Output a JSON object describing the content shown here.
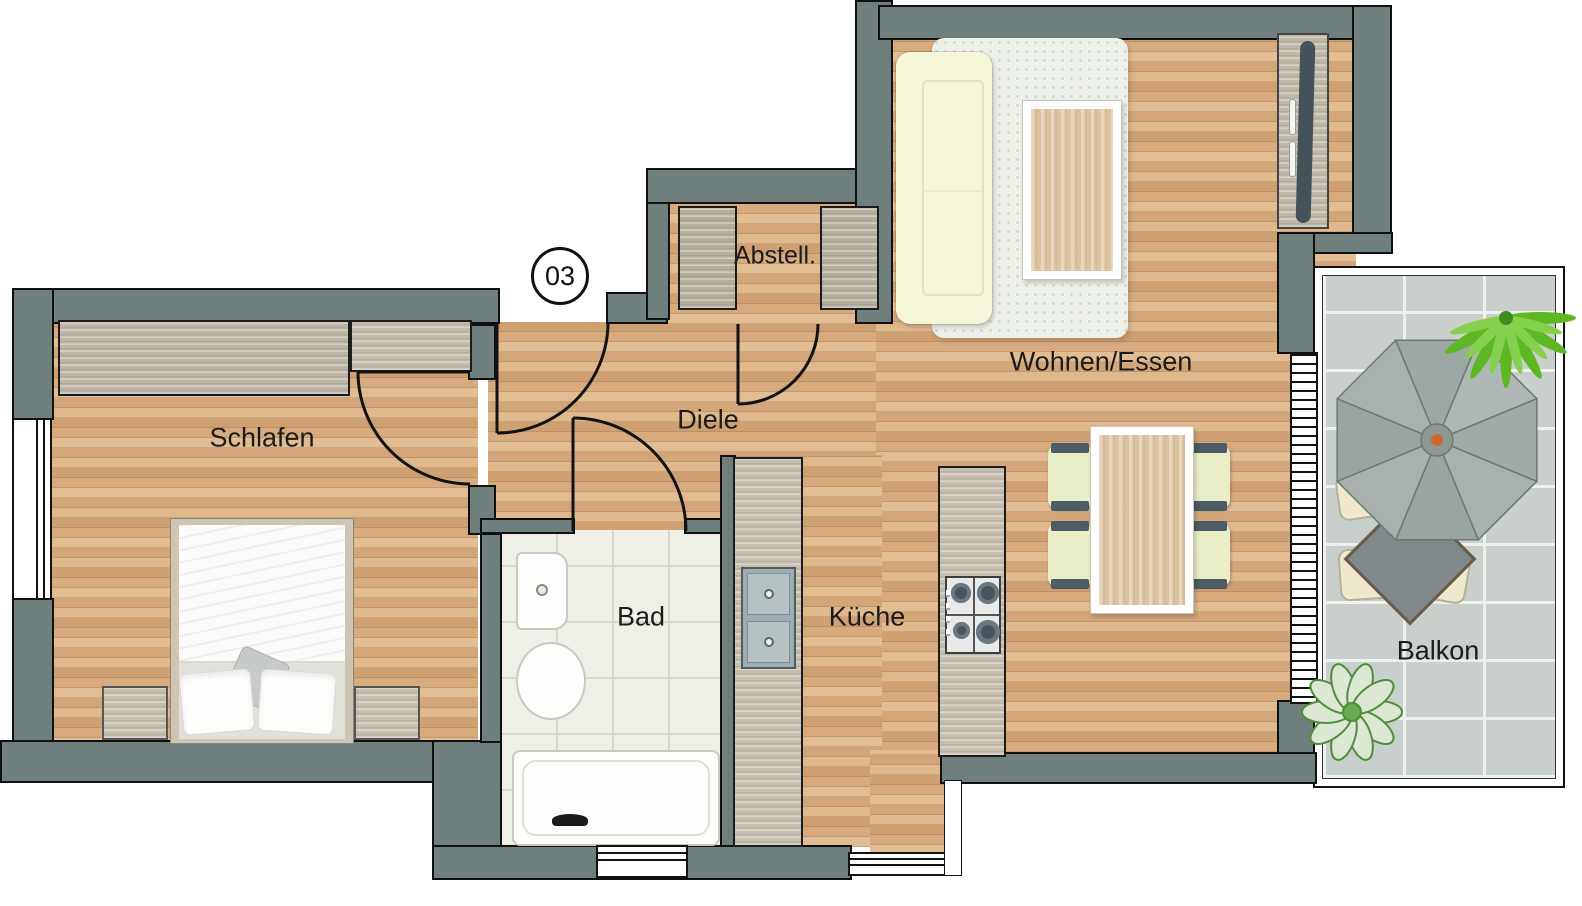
{
  "unit": {
    "number": "03"
  },
  "rooms": {
    "schlafen": "Schlafen",
    "bad": "Bad",
    "diele": "Diele",
    "abstell": "Abstell.",
    "kueche": "Küche",
    "wohnen": "Wohnen/Essen",
    "balkon": "Balkon"
  },
  "colors": {
    "wall": "#6f7f7e",
    "wood_floor": "#d7a97c",
    "bath_tile": "#efeee7",
    "balcony_tile": "#c9cfca",
    "cabinet": "#bdb6a5",
    "sofa": "#f5f6d8",
    "chair": "#eaeec6",
    "rug": "#edf0e8",
    "parasol": "#a3adaa",
    "plant": "#5eb823",
    "label_text": "#1b1b1b"
  }
}
